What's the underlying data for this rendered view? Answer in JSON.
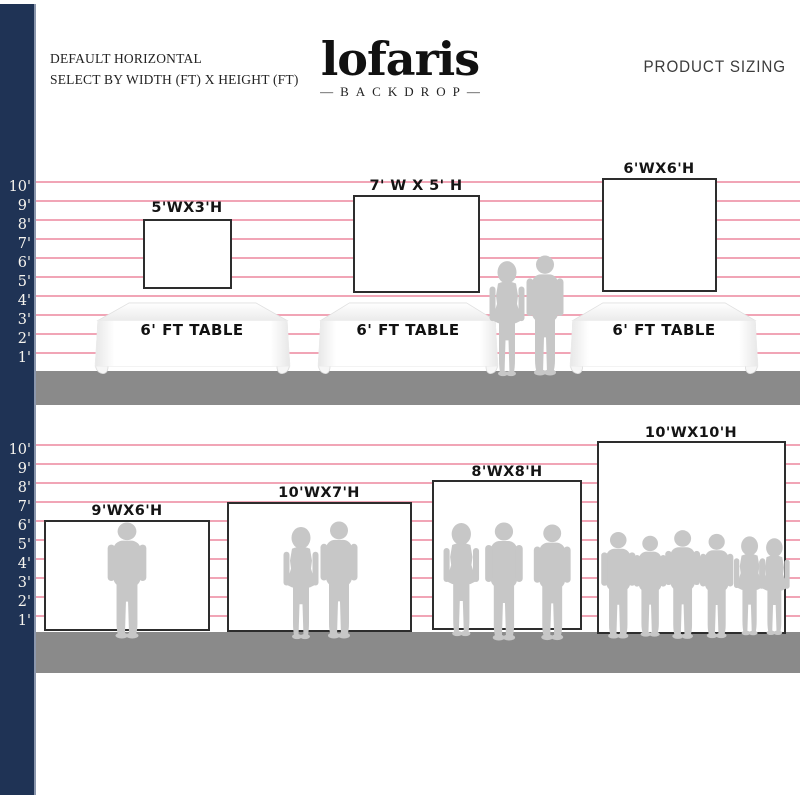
{
  "header": {
    "subtitle_line1": "DEFAULT HORIZONTAL",
    "subtitle_line2": "SELECT BY WIDTH (FT) X HEIGHT (FT)",
    "logo_text": "lofaris",
    "logo_sub": "—BACKDROP—",
    "right_title": "PRODUCT SIZING"
  },
  "ruler_labels": [
    "10'",
    "9'",
    "8'",
    "7'",
    "6'",
    "5'",
    "4'",
    "3'",
    "2'",
    "1'"
  ],
  "section_tables": {
    "backdrops": [
      {
        "label": "5'WX3'H"
      },
      {
        "label": "7' W X 5' H"
      },
      {
        "label": "6'WX6'H"
      }
    ],
    "tables": [
      {
        "label": "6' FT TABLE"
      },
      {
        "label": "6' FT TABLE"
      },
      {
        "label": "6' FT TABLE"
      }
    ]
  },
  "section_people": {
    "backdrops": [
      {
        "label": "9'WX6'H"
      },
      {
        "label": "10'WX7'H"
      },
      {
        "label": "8'WX8'H"
      },
      {
        "label": "10'WX10'H"
      }
    ]
  },
  "colors": {
    "navy": "#1f3355",
    "pink_line": "#f0a0b2",
    "floor_gray": "#8a8a8a",
    "silhouette_gray": "#c7c7c7",
    "backdrop_border": "#2d2d2d"
  }
}
